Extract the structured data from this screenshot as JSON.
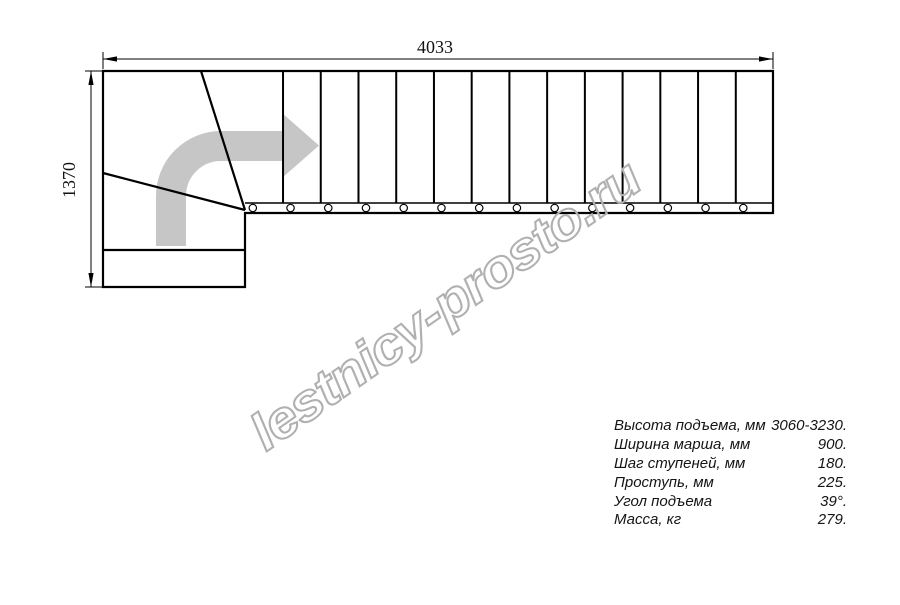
{
  "title": "Stair plan drawing",
  "dimensions": {
    "total_length_mm": "4033",
    "total_width_mm": "1370"
  },
  "plan": {
    "straight_steps": 14,
    "winder_steps": 3,
    "direction_arrow": "up-then-right-turn",
    "colors": {
      "line": "#000000",
      "arrow": "#c6c6c6",
      "watermark": "#b0b0b0",
      "spec_text": "#141414"
    }
  },
  "watermark": {
    "text": "lestnicy-prosto.ru",
    "angle_deg": -35
  },
  "specs": {
    "rows": [
      {
        "label": "Высота подъема, мм",
        "value": "3060-3230."
      },
      {
        "label": "Ширина марша, мм",
        "value": "900."
      },
      {
        "label": "Шаг ступеней, мм",
        "value": "180."
      },
      {
        "label": "Проступь, мм",
        "value": "225."
      },
      {
        "label": "Угол подъема",
        "value": "39°."
      },
      {
        "label": "Масса, кг",
        "value": "279."
      }
    ]
  }
}
